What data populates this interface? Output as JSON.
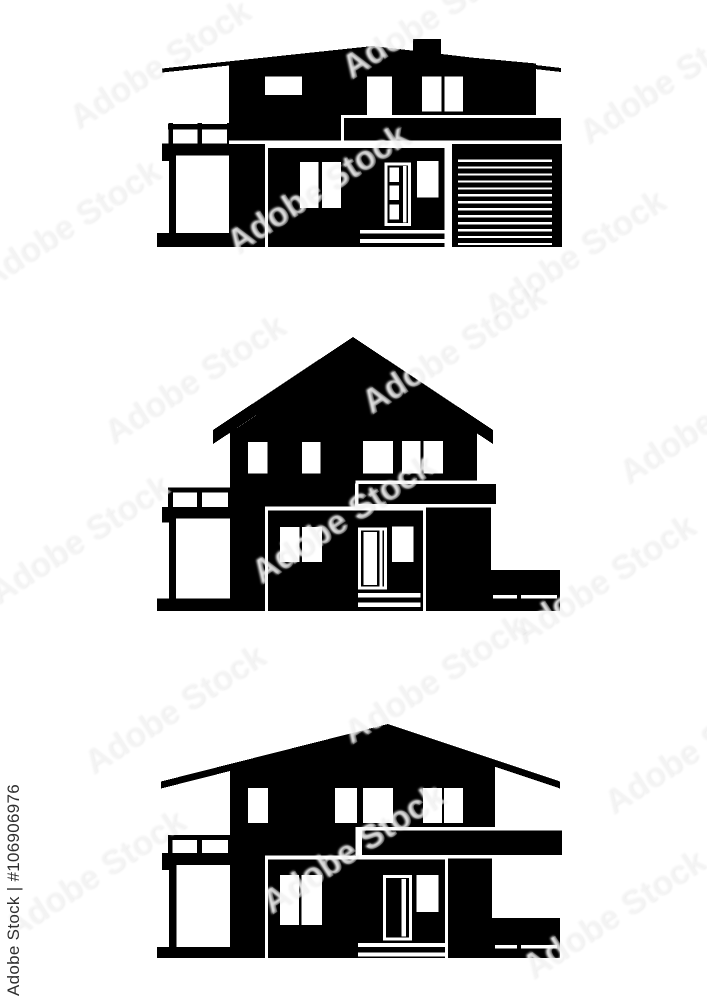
{
  "page": {
    "background_color": "#ffffff",
    "artwork_color": "#000000",
    "description": "Set of three black front-view house silhouette icons on white background"
  },
  "watermark": {
    "tile_text": "Adobe Stock",
    "id_text": "Adobe Stock | #106906976",
    "id_color": "#2e2e2e"
  },
  "houses": [
    {
      "id": "house-1",
      "label": "two-story modern house with low sloped roof, chimney, left balcony, entrance door and striped garage door"
    },
    {
      "id": "house-2",
      "label": "two-story gable-roof house with left balcony, entrance door and right side terrace"
    },
    {
      "id": "house-3",
      "label": "two-story hip-roof house with left balcony, entrance door and right carport"
    }
  ]
}
